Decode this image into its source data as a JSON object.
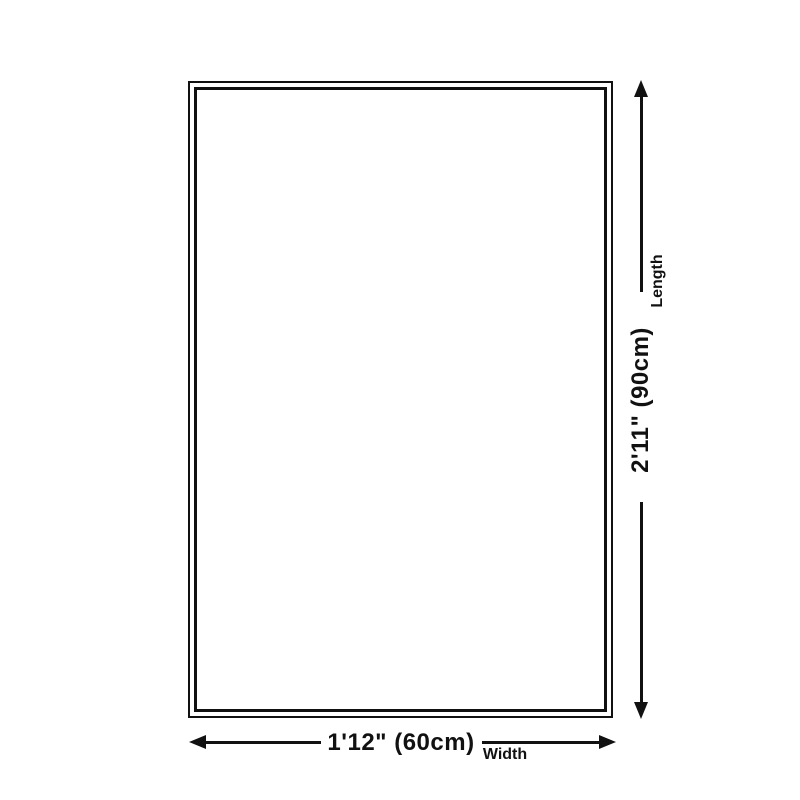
{
  "diagram": {
    "type": "product-dimension-diagram",
    "background_color": "#ffffff",
    "line_color": "#111111",
    "product_shape": "rectangle-outline",
    "width_dimension": {
      "value": "1'12\" (60cm)",
      "axis_label": "Width",
      "orientation": "horizontal"
    },
    "length_dimension": {
      "value": "2'11\" (90cm)",
      "axis_label": "Length",
      "orientation": "vertical"
    }
  }
}
